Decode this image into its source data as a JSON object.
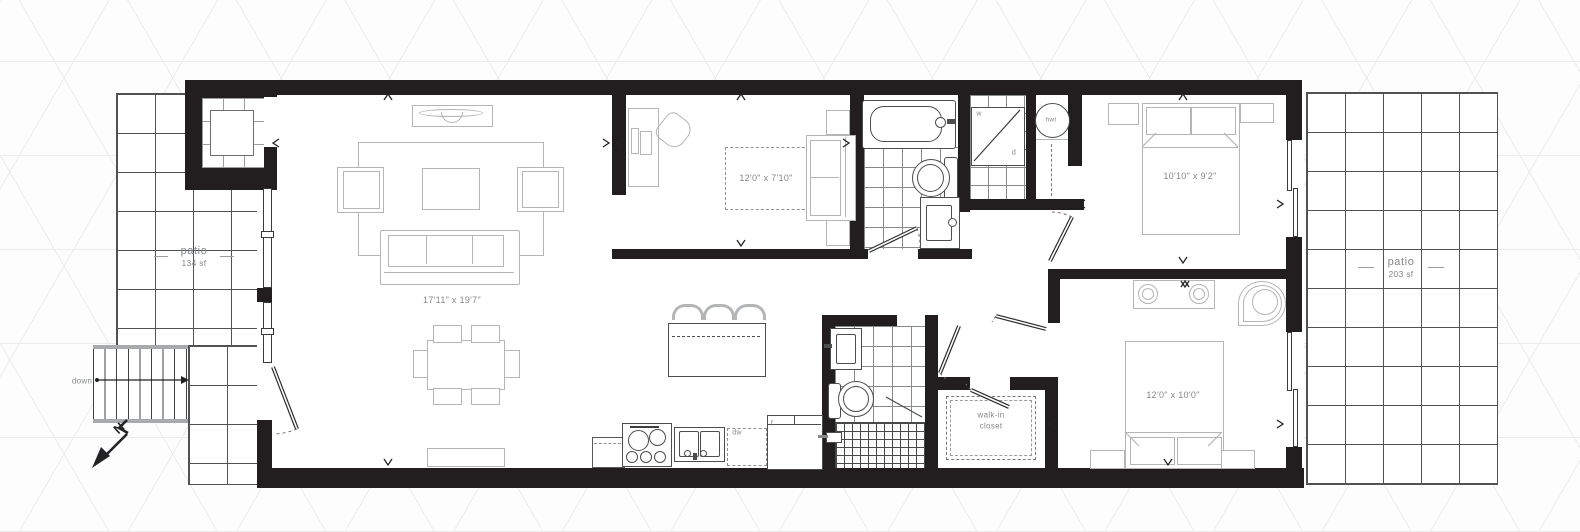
{
  "colors": {
    "wall": "#221e1f",
    "furniture_outline": "#b3b5b7",
    "fixture_outline": "#4c4d4f",
    "grid_line": "#515254",
    "label_text": "#85878a",
    "background_pattern": "#ececec"
  },
  "labels": {
    "living_dims": "17'11\" x 19'7\"",
    "den_dims": "12'0\" x 7'10\"",
    "bedroom1_dims": "10'10\" x 9'2\"",
    "bedroom2_dims": "12'0\" x 10'0\"",
    "walkin_line1": "walk-in",
    "walkin_line2": "closet",
    "patio_left_name": "patio",
    "patio_left_area": "134 sf",
    "patio_right_name": "patio",
    "patio_right_area": "203 sf",
    "stairs_down": "down",
    "north": "N",
    "washer": "w",
    "dryer": "d",
    "hot_water_tank": "hwt",
    "dishwasher": "dw",
    "fridge": "f"
  }
}
